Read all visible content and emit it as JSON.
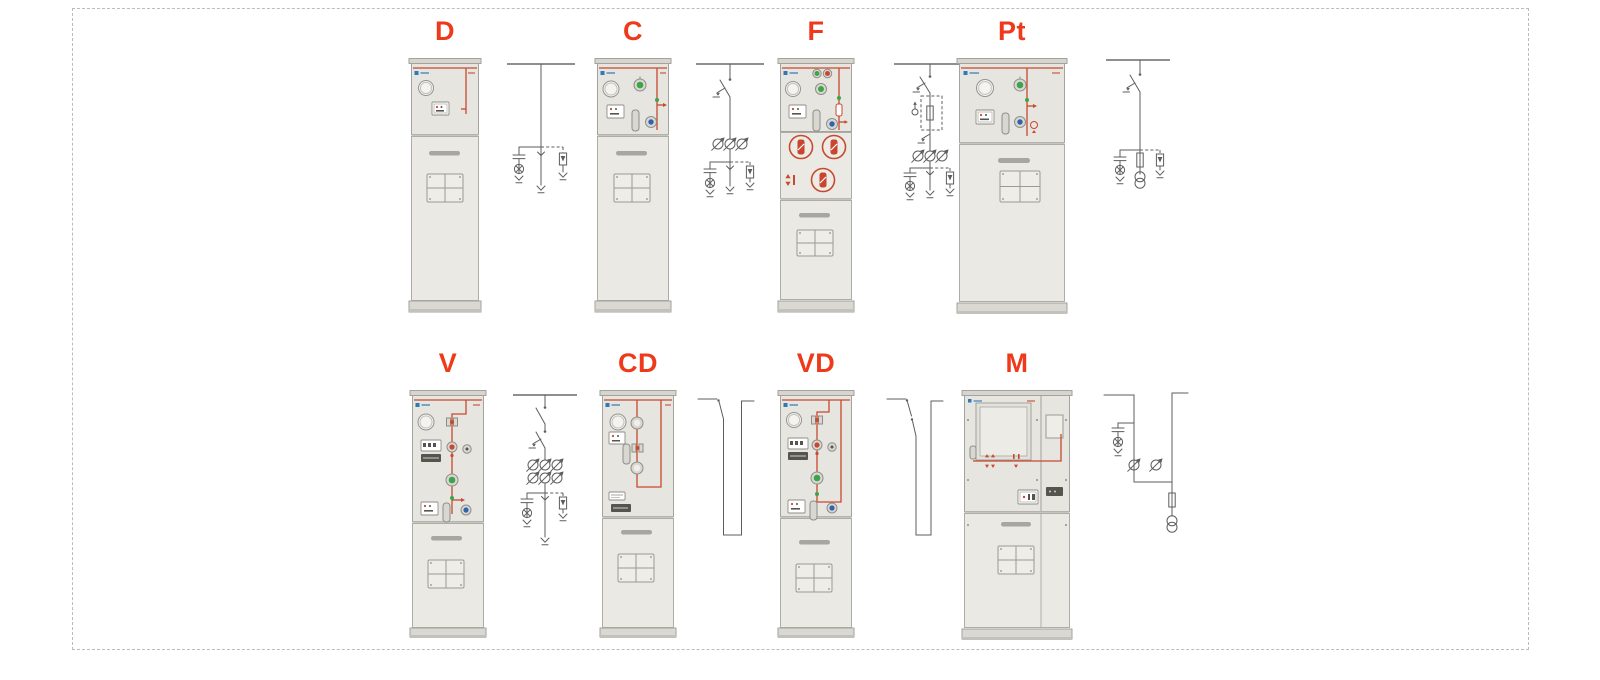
{
  "page": {
    "background": "#ffffff",
    "frame_border_color": "#b4bfc5",
    "label_color": "#ee3a1a",
    "cabinet_body_color": "#e6e5e0",
    "mimic_line_color": "#c74a2f",
    "logo_color": "#2f79b7",
    "indicator_green": "#3ea449",
    "indicator_blue": "#2f64ad",
    "schematic_stroke": "#5d5d5d"
  },
  "units": [
    {
      "id": "d",
      "label": "D",
      "cabinet": "compact",
      "schematic_symbols": [
        "busbar",
        "cable-feeder",
        "capacitor",
        "indicator-lamp",
        "surge-arrester",
        "earth-terminal"
      ]
    },
    {
      "id": "c",
      "label": "C",
      "cabinet": "compact",
      "schematic_symbols": [
        "busbar",
        "load-break-switch",
        "earthing-switch",
        "current-transformers",
        "capacitor",
        "indicator-lamp",
        "surge-arrester",
        "earth-terminal"
      ]
    },
    {
      "id": "f",
      "label": "F",
      "cabinet": "compact-with-fuse-compartment",
      "schematic_symbols": [
        "busbar",
        "load-break-switch",
        "earthing-switch",
        "fuse",
        "striker",
        "current-transformers",
        "capacitor",
        "indicator-lamp",
        "surge-arrester",
        "earth-terminal"
      ]
    },
    {
      "id": "pt",
      "label": "Pt",
      "cabinet": "wide",
      "schematic_symbols": [
        "busbar",
        "load-break-switch",
        "earthing-switch",
        "fuse",
        "voltage-transformer",
        "capacitor",
        "indicator-lamp",
        "surge-arrester",
        "earth-terminal"
      ]
    },
    {
      "id": "v",
      "label": "V",
      "cabinet": "compact-tall-panel",
      "schematic_symbols": [
        "busbar",
        "disconnector",
        "circuit-breaker",
        "earthing-switch",
        "current-transformers",
        "capacitor",
        "indicator-lamp",
        "surge-arrester",
        "earth-terminal"
      ]
    },
    {
      "id": "cd",
      "label": "CD",
      "cabinet": "compact-tall-panel",
      "schematic_symbols": [
        "bus-riser",
        "disconnector"
      ]
    },
    {
      "id": "vd",
      "label": "VD",
      "cabinet": "compact-tall-panel",
      "schematic_symbols": [
        "bus-riser",
        "disconnector",
        "circuit-breaker"
      ]
    },
    {
      "id": "m",
      "label": "M",
      "cabinet": "wide-metering",
      "schematic_symbols": [
        "busbar",
        "capacitor",
        "indicator-lamp",
        "connectors",
        "fuse",
        "voltage-transformer"
      ]
    }
  ]
}
